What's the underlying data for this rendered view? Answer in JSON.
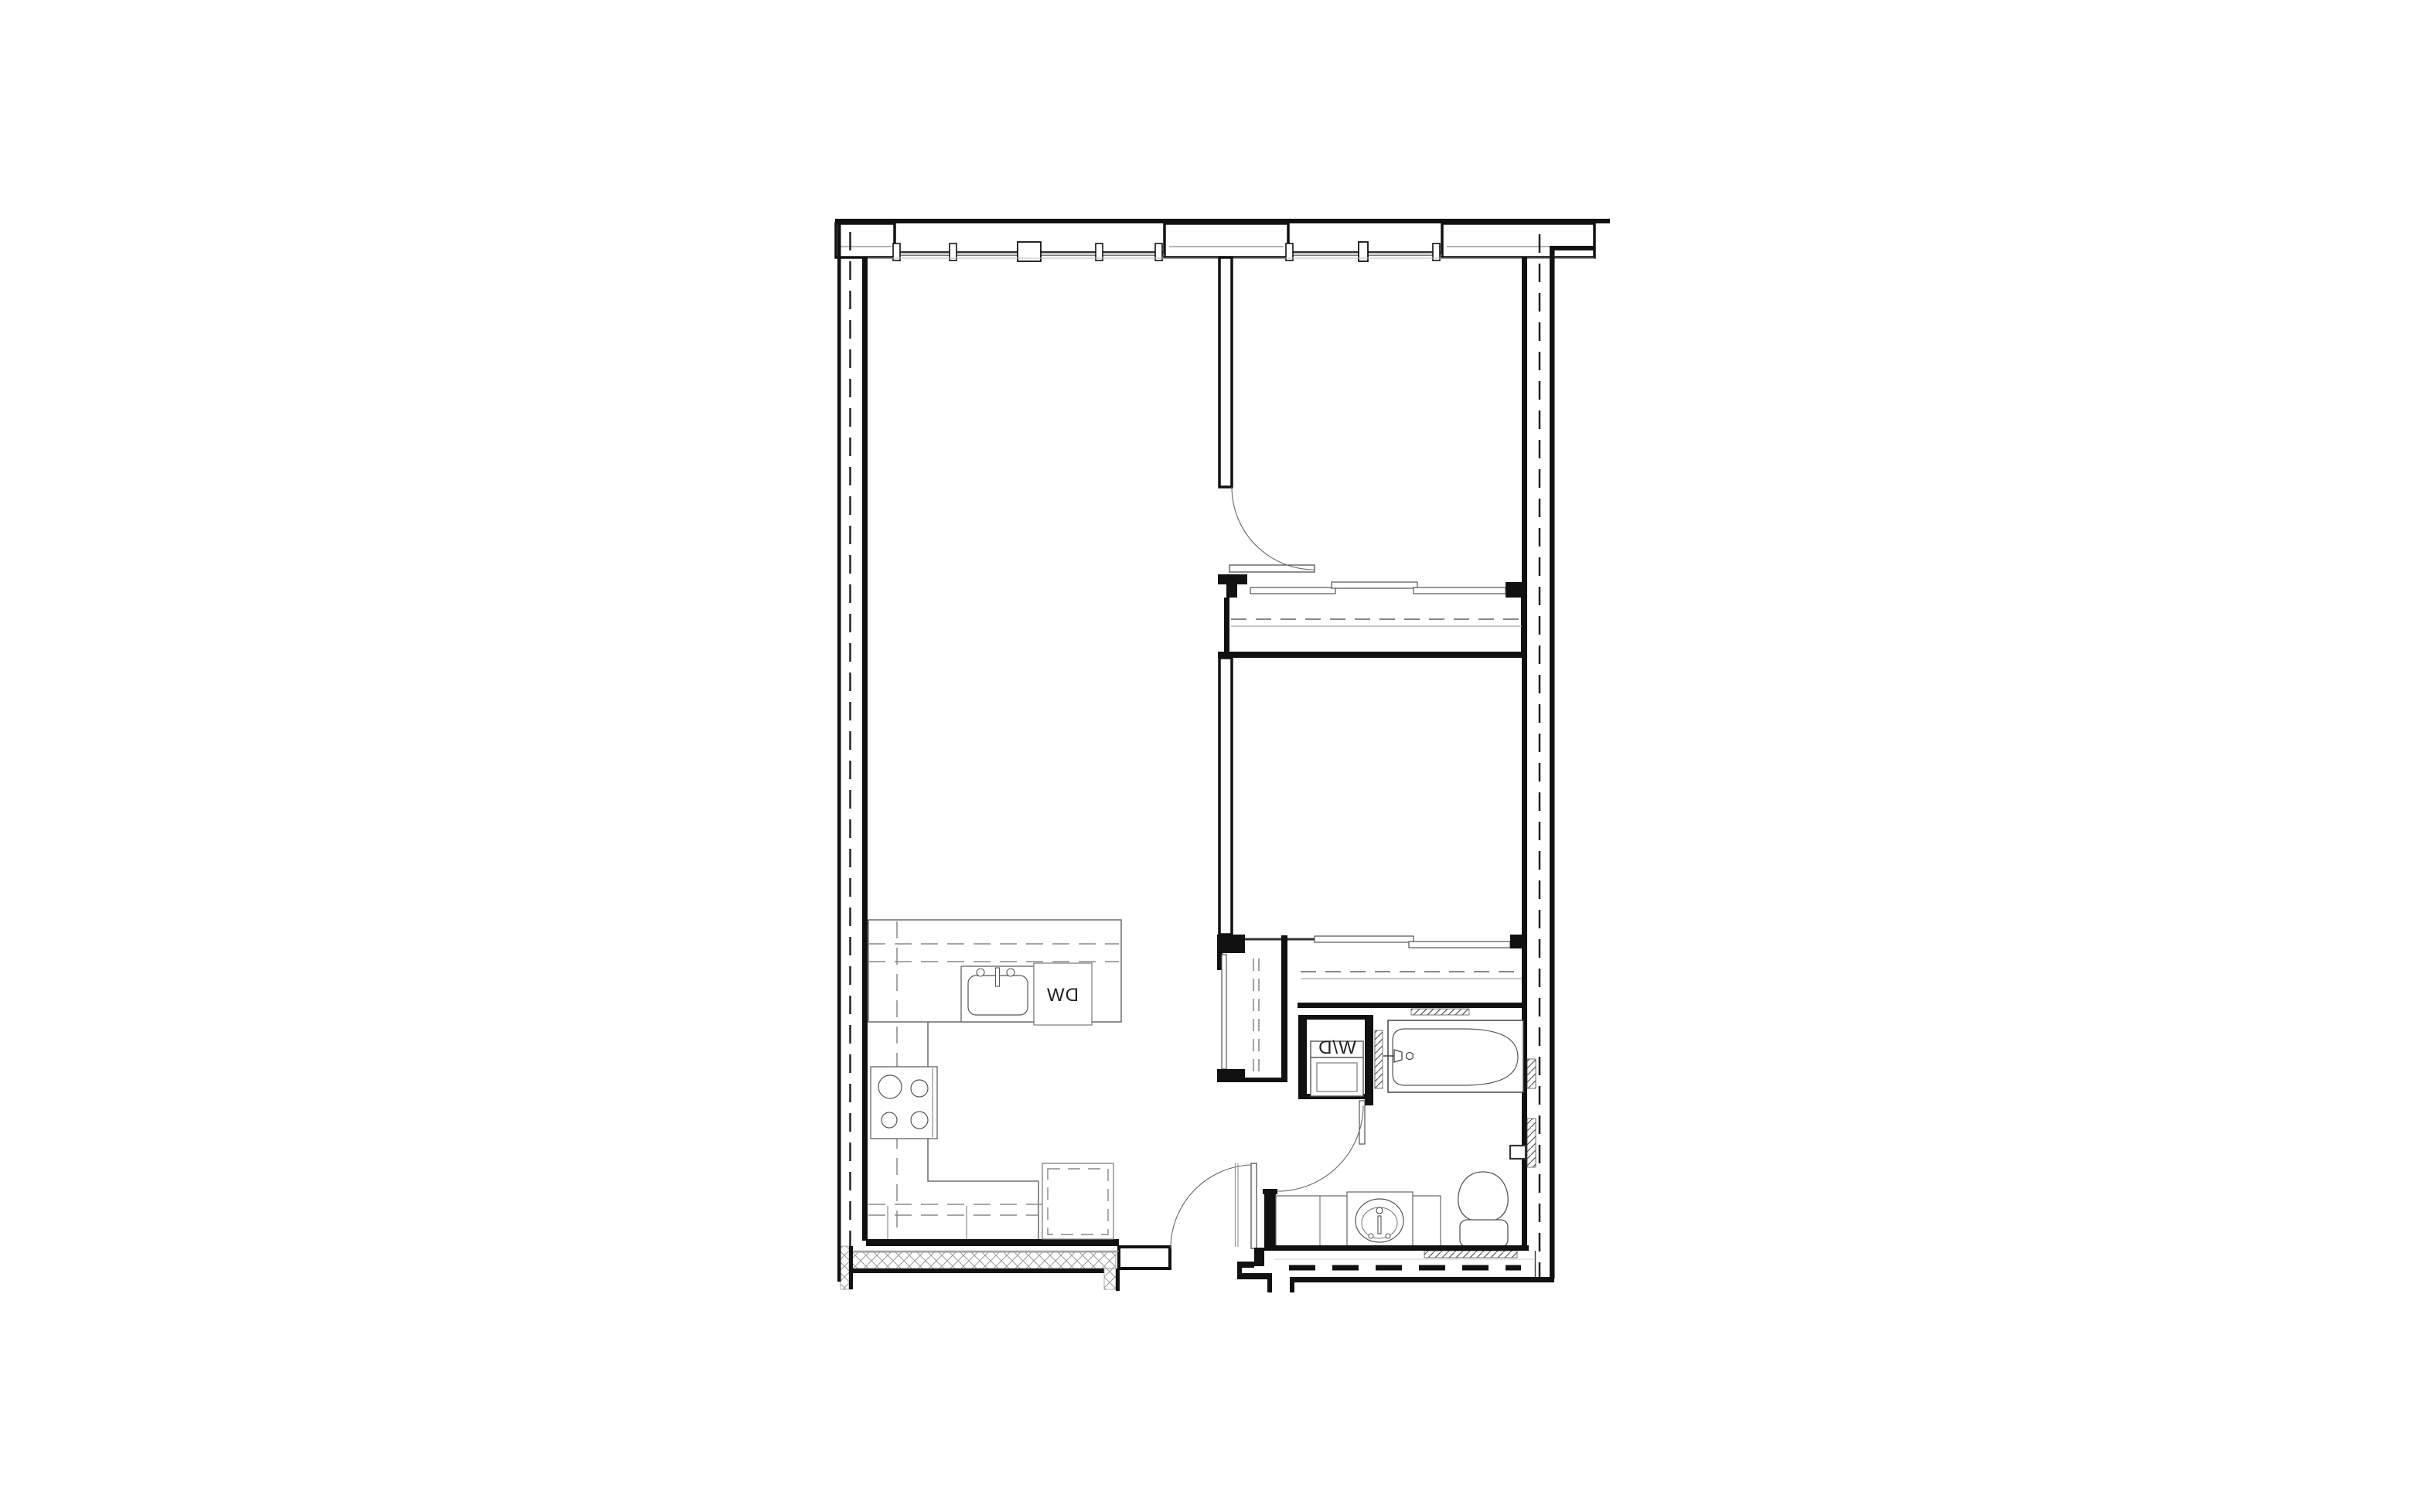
{
  "title": "apartment-unit-floor-plan",
  "labels": {
    "dishwasher": "DW",
    "washer_dryer": "W/D"
  },
  "colors": {
    "wall": "#111111",
    "thin_line": "#444444",
    "light_line": "#9a9a9a",
    "dashed_line": "#888888",
    "hatch": "#555555",
    "background": "#ffffff"
  },
  "icons": {
    "kitchen_sink": "kitchen-sink-icon",
    "bathroom_sink": "bathroom-sink-icon",
    "stove": "stove-burners-icon",
    "refrigerator": "refrigerator-icon",
    "bathtub": "bathtub-icon",
    "toilet": "toilet-icon",
    "washer_dryer": "stacked-washer-dryer-icon",
    "door_swing": "door-swing-arc-icon",
    "window": "window-mullion-icon",
    "closet_rod": "closet-rod-dashed-icon"
  }
}
